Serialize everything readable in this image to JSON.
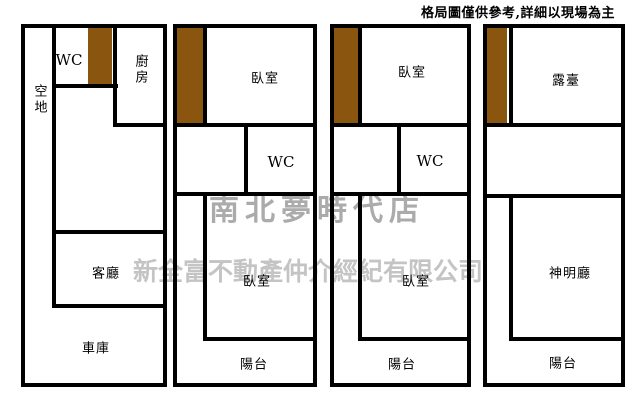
{
  "disclaimer": "格局圖僅供參考,詳細以現場為主",
  "watermarks": {
    "store": "南北夢時代店",
    "company": "新全富不動產仲介經紀有限公司"
  },
  "colors": {
    "wall": "#000000",
    "stairs": "#8a560f",
    "watermark_store": "#ababab",
    "watermark_company": "#c4c4c4"
  },
  "units": [
    {
      "id": "unit-1",
      "labels": {
        "open_space": "空地",
        "wc": "WC",
        "kitchen": "廚房",
        "living_room": "客廳",
        "garage": "車庫"
      }
    },
    {
      "id": "unit-2",
      "labels": {
        "bedroom_top": "臥室",
        "wc": "WC",
        "bedroom_bottom": "臥室",
        "balcony": "陽台"
      }
    },
    {
      "id": "unit-3",
      "labels": {
        "bedroom_top": "臥室",
        "wc": "WC",
        "bedroom_bottom": "臥室",
        "balcony": "陽台"
      }
    },
    {
      "id": "unit-4",
      "labels": {
        "terrace": "露臺",
        "shrine_hall": "神明廳",
        "balcony": "陽台"
      }
    }
  ]
}
